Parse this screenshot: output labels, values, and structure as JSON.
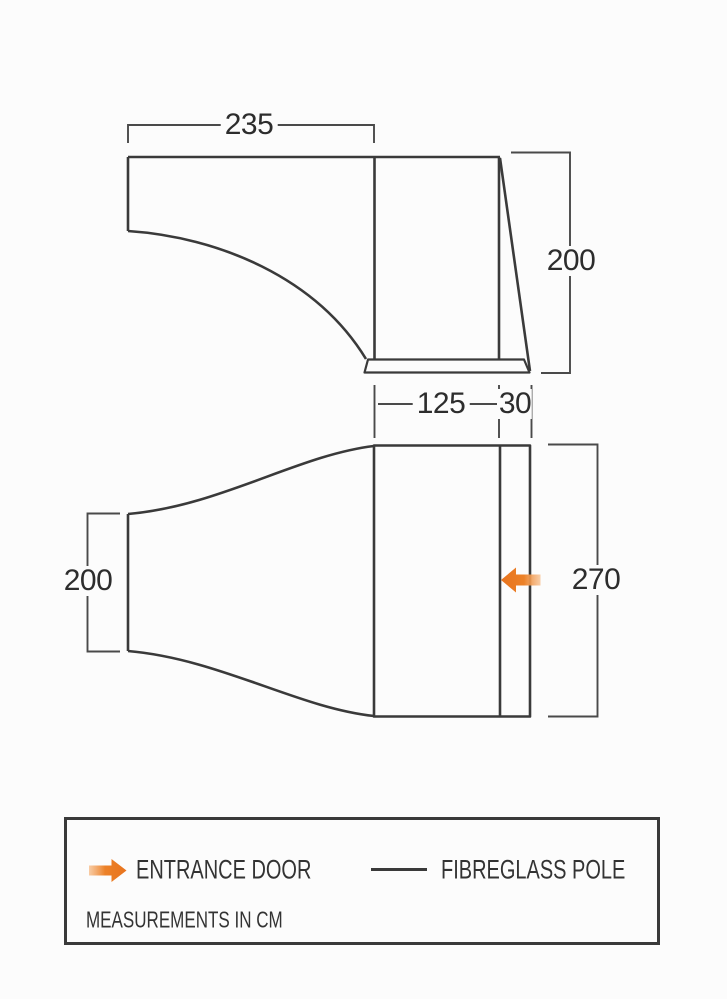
{
  "diagram": {
    "units_note": "MEASUREMENTS IN CM",
    "side_view": {
      "name": "side elevation",
      "dimensions": {
        "top_width_cm": "235",
        "rear_height_cm": "200"
      }
    },
    "plan_view": {
      "name": "plan view",
      "dimensions": {
        "canopy_depth_cm": "125",
        "pole_section_depth_cm": "30",
        "tunnel_width_cm": "200",
        "overall_width_cm": "270"
      }
    },
    "legend": {
      "entrance_door_label": "ENTRANCE DOOR",
      "fibreglass_pole_label": "FIBREGLASS POLE"
    },
    "colors": {
      "outline": "#3a3a3a",
      "dimension_line": "#4a4a4a",
      "accent_orange": "#e8741e",
      "background": "#fcfcfc",
      "text": "#2d2d2d"
    }
  }
}
